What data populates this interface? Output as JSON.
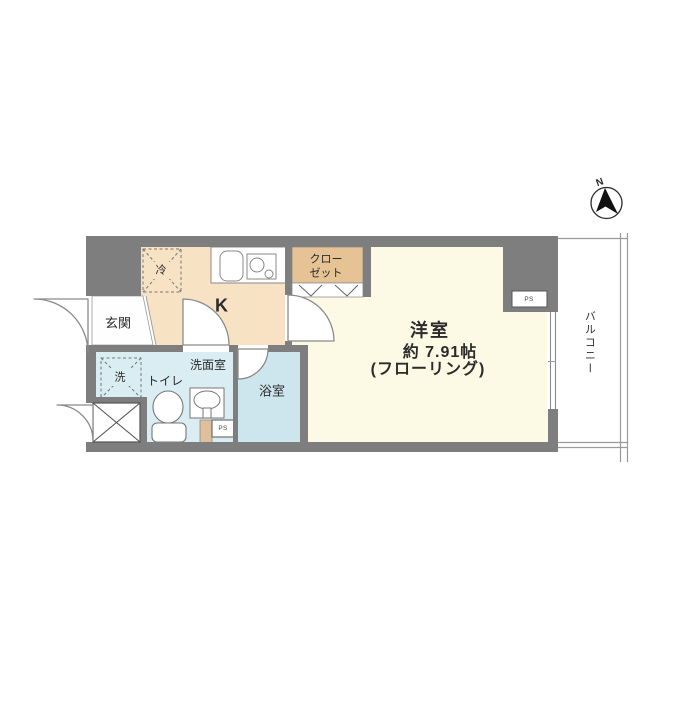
{
  "labels": {
    "entrance": "玄関",
    "kitchen": "K",
    "closet_line1": "クロー",
    "closet_line2": "ゼット",
    "main_room_name": "洋室",
    "main_room_size": "約 7.91帖",
    "main_room_floor": "(フローリング)",
    "washroom": "洗面室",
    "toilet": "トイレ",
    "bathroom": "浴室",
    "balcony": "バルコニー",
    "refrigerator": "冷",
    "washer": "洗",
    "ps_top": "PS",
    "ps_bottom": "PS",
    "north": "N"
  },
  "colors": {
    "wall": "#7e7e7e",
    "kitchen": "#f7e2c3",
    "closet": "#e5c394",
    "main_room": "#fcfae4",
    "washroom": "#d9edf2",
    "bathroom": "#cde6ee",
    "genkan": "#fefefe",
    "fixture_tan": "#e0c09a",
    "white": "#ffffff",
    "line": "#8a8a8a",
    "text": "#2b2b2b"
  }
}
